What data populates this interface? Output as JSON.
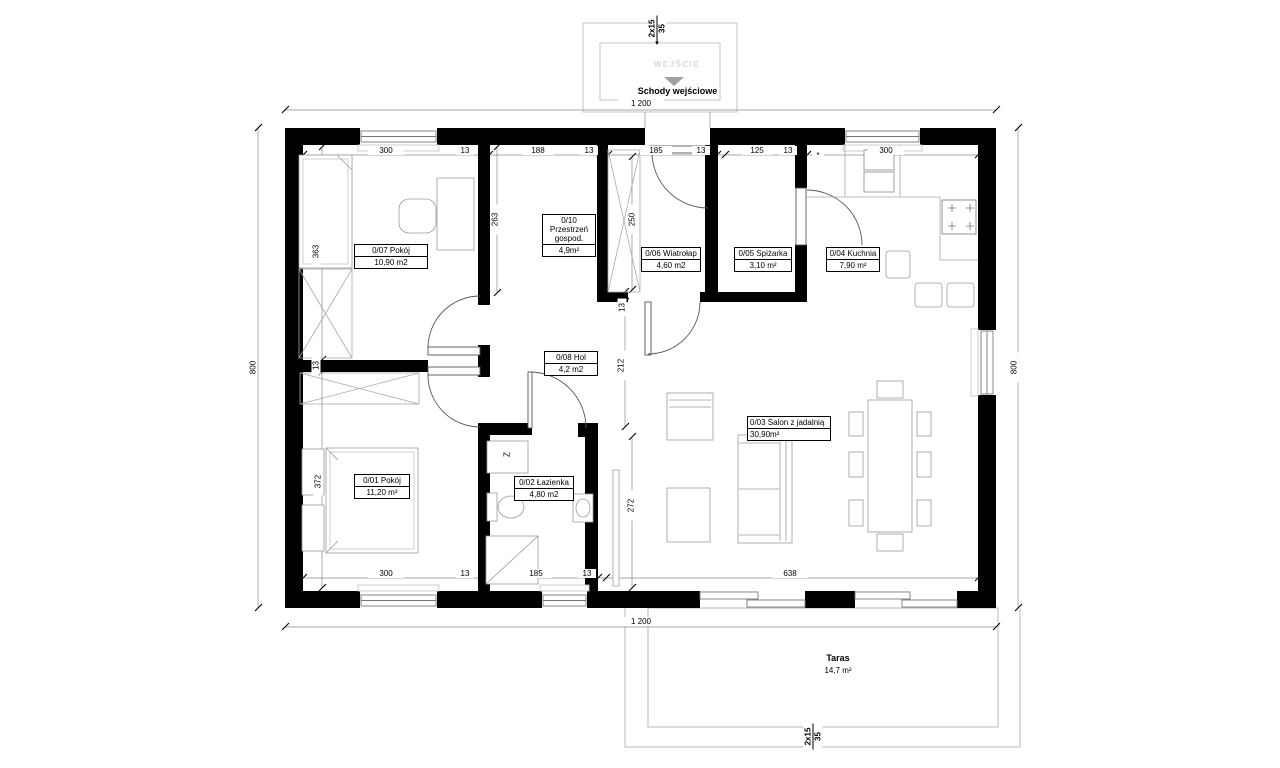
{
  "plan": {
    "rooms": [
      {
        "id": "0/07",
        "name": "0/07 Pokój",
        "area": "10,90 m2"
      },
      {
        "id": "0/10",
        "name": "0/10 Przestrzeń gospod.",
        "area": "4,9m²"
      },
      {
        "id": "0/06",
        "name": "0/06 Wiatrołap",
        "area": "4,60 m2"
      },
      {
        "id": "0/05",
        "name": "0/05 Spiżarka",
        "area": "3,10 m²"
      },
      {
        "id": "0/04",
        "name": "0/04 Kuchnia",
        "area": "7,90 m²"
      },
      {
        "id": "0/08",
        "name": "0/08 Hol",
        "area": "4,2 m2"
      },
      {
        "id": "0/01",
        "name": "0/01 Pokój",
        "area": "11,20 m²"
      },
      {
        "id": "0/02",
        "name": "0/02 Łazienka",
        "area": "4,80 m2"
      },
      {
        "id": "0/03",
        "name": "0/03 Salon z jadalnią",
        "area": "30,90m²"
      }
    ],
    "outside": {
      "terrace_name": "Taras",
      "terrace_area": "14,7 m²",
      "stairs_label": "Schody wejściowe",
      "entrance_label": "WEJŚCIE"
    },
    "stairs_note": {
      "steps": "2x15",
      "tread": "35"
    },
    "fixtures": {
      "washer": "Z"
    },
    "dims": {
      "overall_w": "1 200",
      "overall_h": "800",
      "t300a": "300",
      "t13a": "13",
      "t188": "188",
      "t13b": "13",
      "t185": "185",
      "t13c": "13",
      "t125": "125",
      "t13d": "13",
      "t300b": "300",
      "star": "*",
      "b300": "300",
      "b13a": "13",
      "b185": "185",
      "b13b": "13",
      "b638": "638",
      "l363": "363",
      "l13": "13",
      "l372": "372",
      "v263": "263",
      "v250": "250",
      "v13": "13",
      "v212": "212",
      "v272": "272"
    }
  }
}
